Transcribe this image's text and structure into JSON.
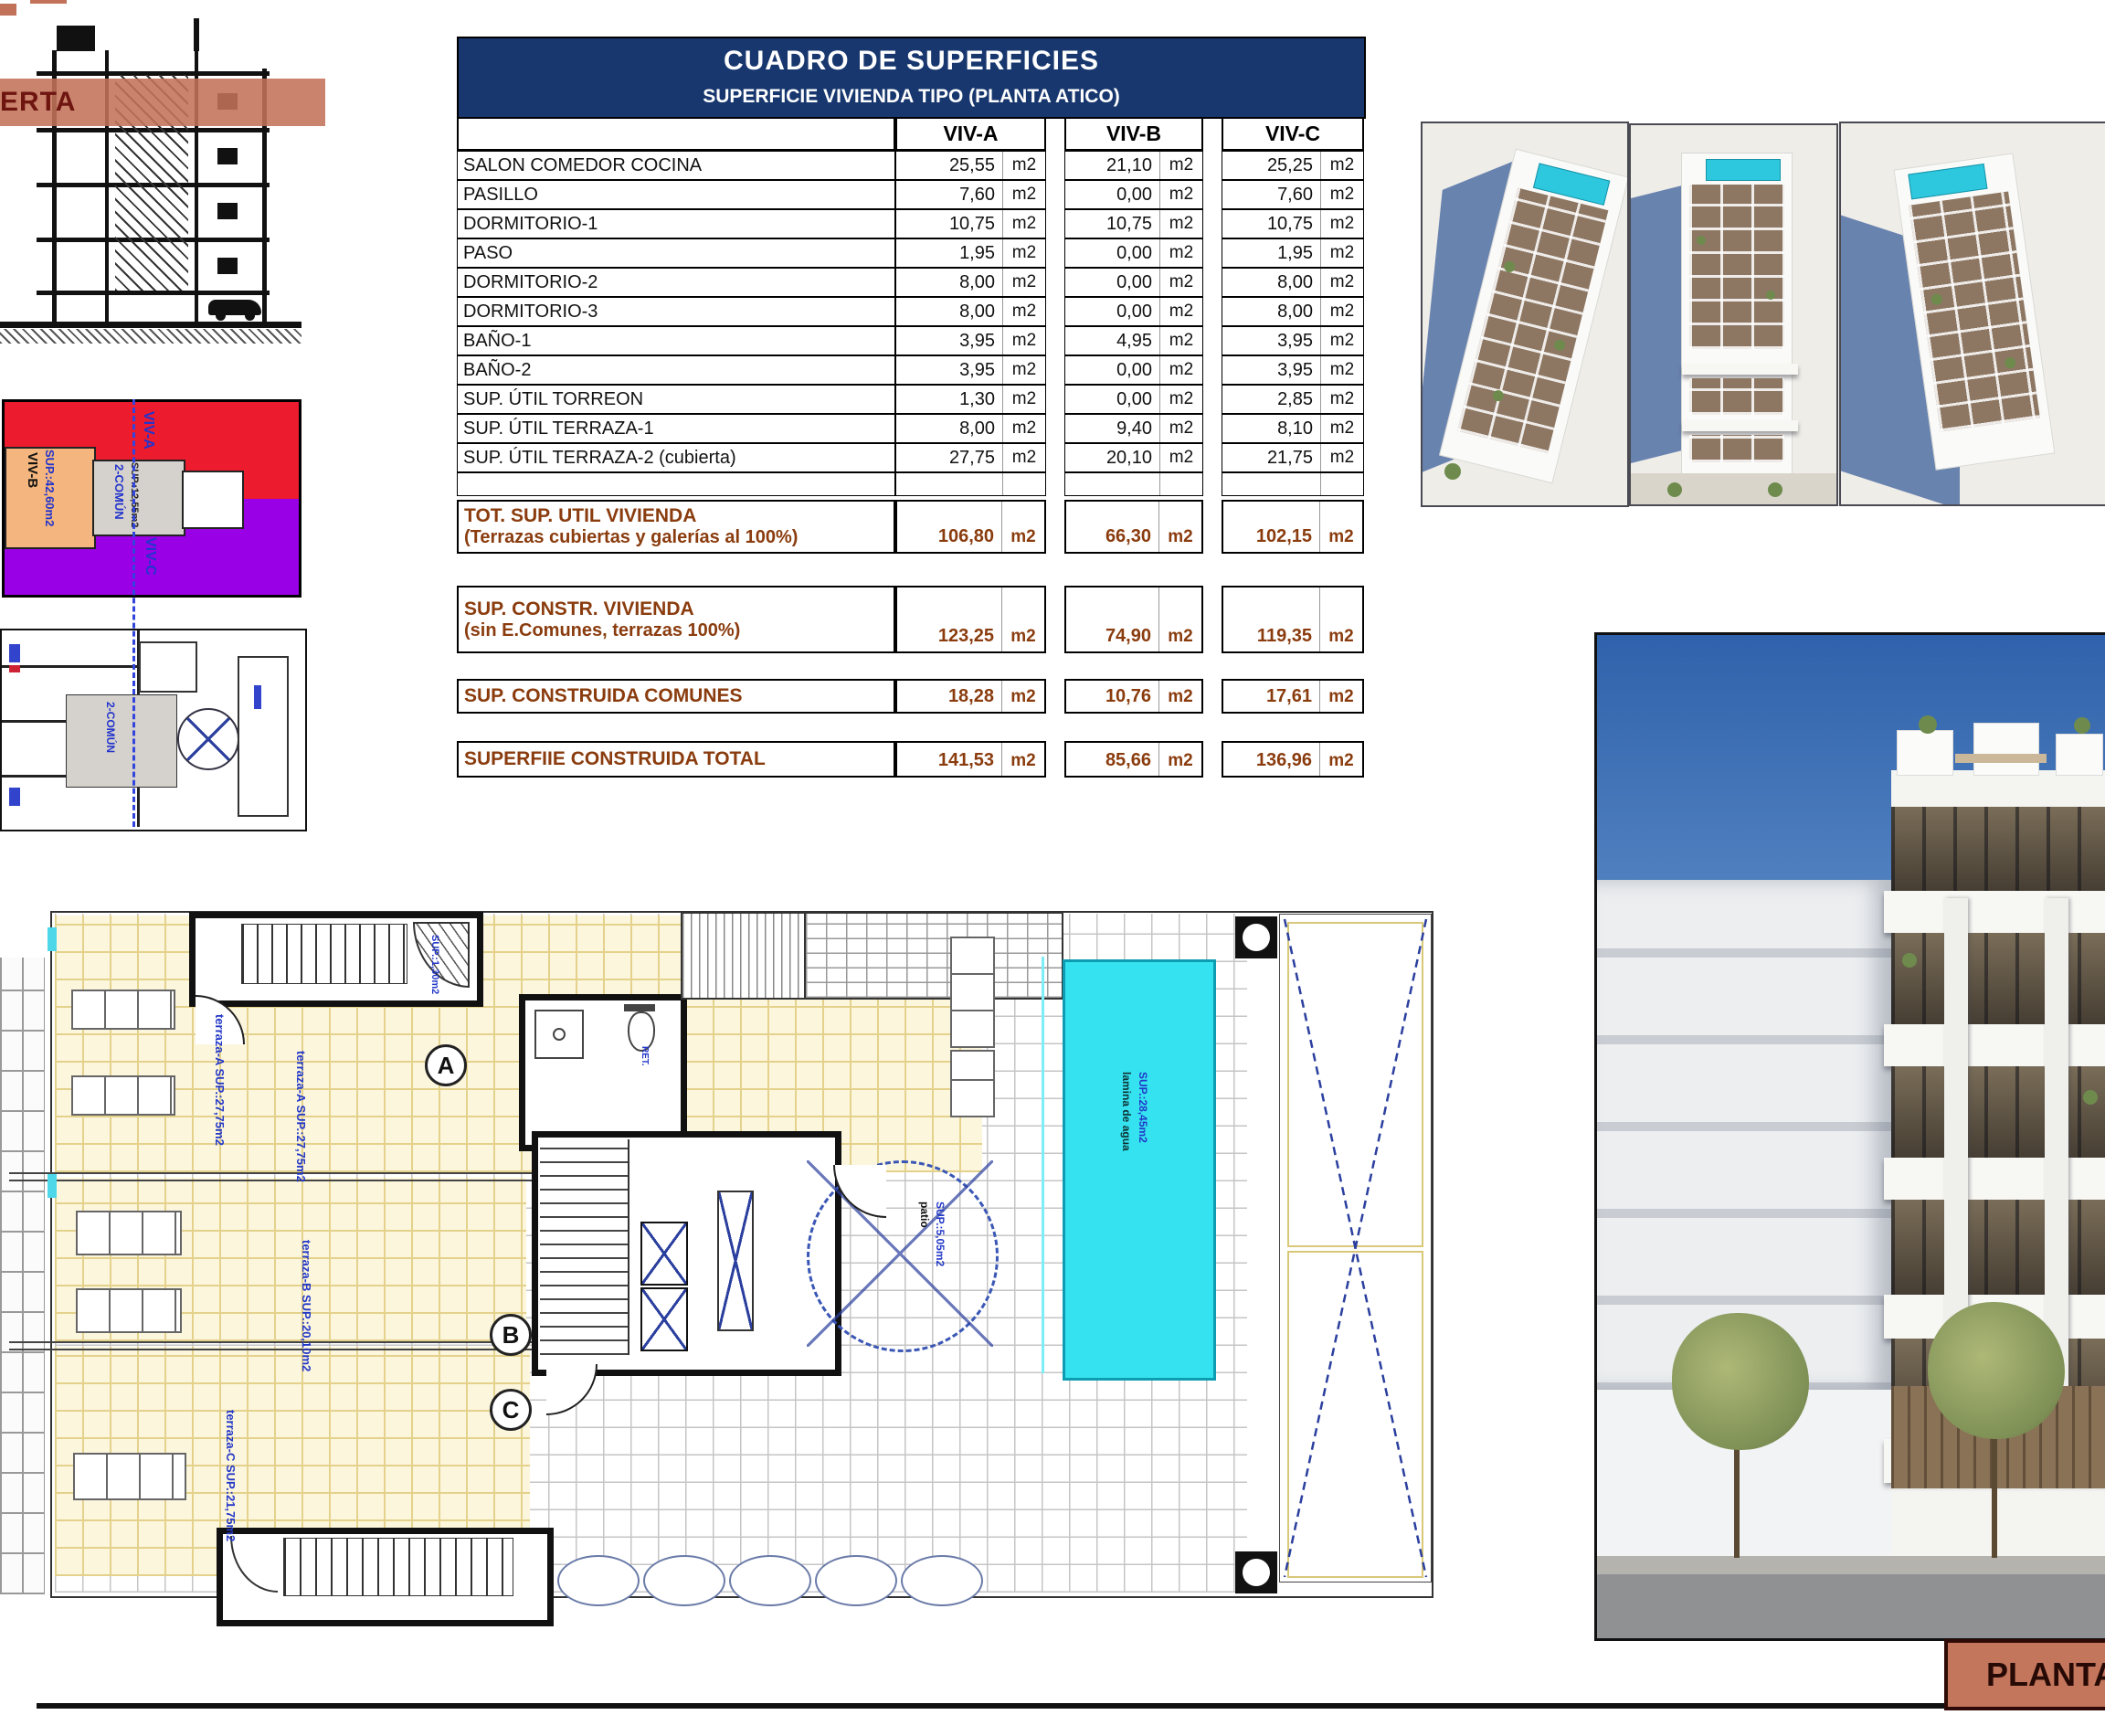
{
  "table": {
    "title": "CUADRO DE SUPERFICIES",
    "subtitle": "SUPERFICIE VIVIENDA TIPO (PLANTA ATICO)",
    "columns": [
      "VIV-A",
      "VIV-B",
      "VIV-C"
    ],
    "unit": "m2",
    "rows": [
      {
        "label": "SALON COMEDOR COCINA",
        "a": "25,55",
        "b": "21,10",
        "c": "25,25"
      },
      {
        "label": "PASILLO",
        "a": "7,60",
        "b": "0,00",
        "c": "7,60"
      },
      {
        "label": "DORMITORIO-1",
        "a": "10,75",
        "b": "10,75",
        "c": "10,75"
      },
      {
        "label": "PASO",
        "a": "1,95",
        "b": "0,00",
        "c": "1,95"
      },
      {
        "label": "DORMITORIO-2",
        "a": "8,00",
        "b": "0,00",
        "c": "8,00"
      },
      {
        "label": "DORMITORIO-3",
        "a": "8,00",
        "b": "0,00",
        "c": "8,00"
      },
      {
        "label": "BAÑO-1",
        "a": "3,95",
        "b": "4,95",
        "c": "3,95"
      },
      {
        "label": "BAÑO-2",
        "a": "3,95",
        "b": "0,00",
        "c": "3,95"
      },
      {
        "label": "SUP. ÚTIL TORREON",
        "a": "1,30",
        "b": "0,00",
        "c": "2,85"
      },
      {
        "label": "SUP. ÚTIL TERRAZA-1",
        "a": "8,00",
        "b": "9,40",
        "c": "8,10"
      },
      {
        "label": "SUP. ÚTIL TERRAZA-2 (cubierta)",
        "a": "27,75",
        "b": "20,10",
        "c": "21,75"
      }
    ],
    "summary": [
      {
        "label": "TOT. SUP. UTIL VIVIENDA",
        "sublabel": "(Terrazas cubiertas y galerías al 100%)",
        "a": "106,80",
        "b": "66,30",
        "c": "102,15"
      },
      {
        "label": "SUP. CONSTR. VIVIENDA",
        "sublabel": "(sin E.Comunes, terrazas 100%)",
        "a": "123,25",
        "b": "74,90",
        "c": "119,35"
      },
      {
        "label": "SUP. CONSTRUIDA COMUNES",
        "sublabel": "",
        "a": "18,28",
        "b": "10,76",
        "c": "17,61"
      },
      {
        "label": "SUPERFIIE CONSTRUIDA TOTAL",
        "sublabel": "",
        "a": "141,53",
        "b": "85,66",
        "c": "136,96"
      }
    ]
  },
  "section": {
    "band_label": "ERTA"
  },
  "zoning": {
    "viv_a": "VIV-A",
    "viv_b": "VIV-B",
    "viv_b_sup": "SUP.:42,60m2",
    "viv_c": "VIV-C",
    "comun": "2-COMÚN",
    "comun_sup": "SUP.:12,55m2"
  },
  "schematic": {
    "comun": "2-COMÚN"
  },
  "plan": {
    "terraza_a": "terraza-A SUP.:27,75m2",
    "terraza_a2": "terraza-A SUP.:27,75m2",
    "terraza_b": "terraza-B SUP.:20,10m2",
    "terraza_c": "terraza-C SUP.:21,75m2",
    "pool_line1": "lamina de agua",
    "pool_line2": "SUP.:28,45m2",
    "patio_line1": "patio",
    "patio_line2": "SUP.:5,05m2",
    "torreon_sup": "SUP.:1,30m2",
    "ret": "RET.",
    "marker_a": "A",
    "marker_b": "B",
    "marker_c": "C"
  },
  "footer": {
    "plate_label": "PLANTA ATICO"
  },
  "colors": {
    "navy": "#17376e",
    "summary_brown": "#8a3c0e",
    "salmon": "#c3765c",
    "zone_red": "#ec1b2e",
    "zone_purple": "#9a00e6",
    "zone_orange": "#f4b67e",
    "zone_gray": "#d5d2cd",
    "pool_cyan": "#34e2f0",
    "plan_blue": "#2338c8"
  }
}
